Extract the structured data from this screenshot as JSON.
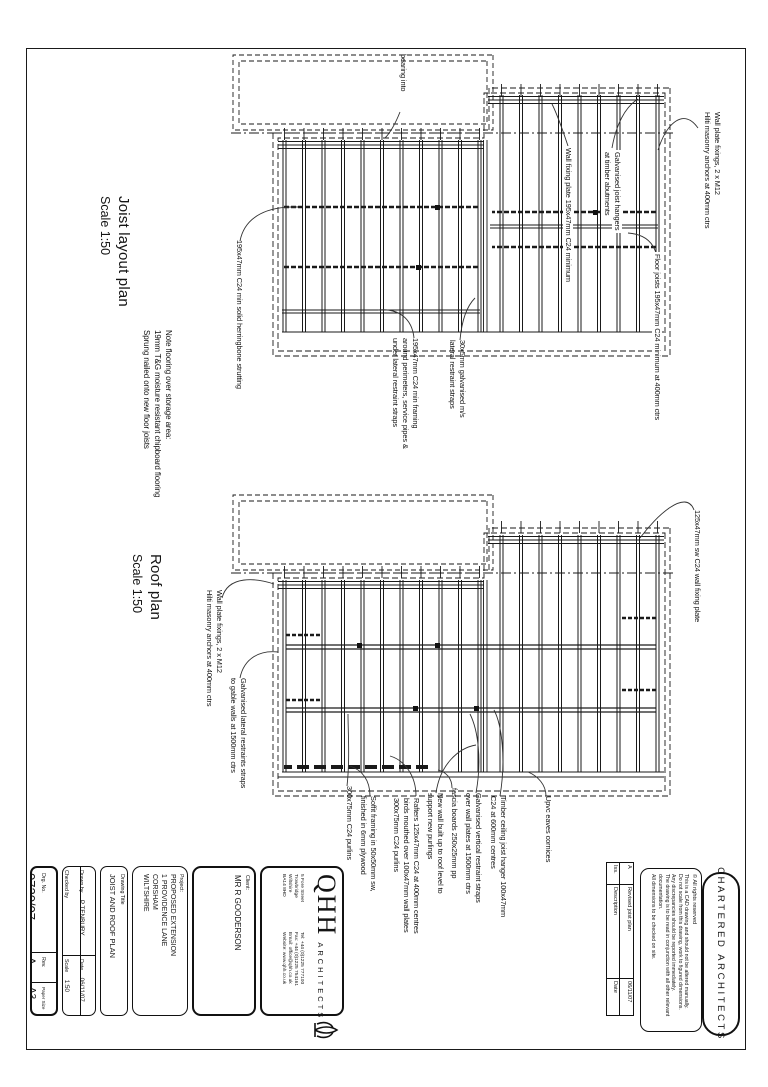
{
  "joist_plan": {
    "title": "Joist layout plan",
    "scale": "Scale 1:50",
    "note": [
      "Note flooring over storage area:",
      "19mm T&G moisture resistant chipboard flooring",
      "Sprung nailed onto new floor joists"
    ],
    "ann_bearing": "bearing into",
    "ann_wall_plate": [
      "Wall plate fixings, 2 x M12",
      "Hilti masonry anchors at 400mm ctrs"
    ],
    "ann_wall_fixing_plate": "Wall fixing plate 195x47mm C24 minimum",
    "ann_hangers": [
      "Galvanised joist hangers",
      "at timber abutments"
    ],
    "ann_floor_joists": "Floor joists 195x47mm C24 minimum at 400mm ctrs",
    "ann_strutting": "195x47mm C24 min solid herringbone strutting",
    "ann_framing": [
      "195x47mm C24 min framing",
      "around perimeters, service pipes &",
      "under lateral restraint straps"
    ],
    "ann_straps": [
      "30x5mm galvanised m/s",
      "lateral restraint straps"
    ]
  },
  "roof_plan": {
    "title": "Roof plan",
    "scale": "Scale 1:50",
    "ann_wall_plate": [
      "Wall plate fixings, 2 x M12",
      "Hilti masonry anchors at 400mm ctrs"
    ],
    "ann_gable_straps": [
      "Galvanised lateral restraints straps",
      "to gable walls at 1500mm ctrs"
    ],
    "ann_purlins": "300x75mm C24 purlins",
    "ann_soffit": [
      "Soffit framing in 50x50mm sw,",
      "finished in 6mm plywood"
    ],
    "ann_rafters": [
      "Rafters 125x47mm C24 at 400mm centres",
      "birds mouthed over 100x47mm wall plates",
      "300x75mm C24 purlins"
    ],
    "ann_new_wall": [
      "New wall built up to roof level to",
      "support new purlings"
    ],
    "ann_fascia": "fascia boards 250x25mm pp",
    "ann_vert_straps": [
      "Galvanised vertical restraint straps",
      "over wall plates at 1500mm ctrs"
    ],
    "ann_ceiling_hanger": [
      "Timber ceiling joist hanger 100x47mm",
      "C24 at 600mm centres"
    ],
    "ann_eaves": "Upvc eaves cornices",
    "ann_wall_fixing_plate": "125x47mm sw C24 wall fixing plate"
  },
  "title_block": {
    "drg_no_label": "Drg. No.",
    "drg_no": "0720/07",
    "rev_label": "Rev.",
    "rev": "A",
    "paper_label": "Paper Size",
    "paper": "A3",
    "drawn_label": "Drawn by",
    "drawn": "P TENBURY",
    "checked_label": "Checked by",
    "checked": "",
    "date_label": "Date",
    "date": "06/11/07",
    "scale_label": "Scale",
    "scale": "1:50",
    "title_label": "Drawing Title",
    "title": "JOIST AND ROOF PLAN",
    "project_label": "Project:",
    "project": [
      "PROPOSED EXTENSION",
      "1 PROVIDENCE LANE",
      "CORSHAM",
      "WILTSHIRE"
    ],
    "client_label": "Client:",
    "client": "MR R GOODERSON"
  },
  "firm": {
    "name": "QHH",
    "type": "ARCHITECTS",
    "address": [
      "5 Fore Street",
      "Trowbridge",
      "Wiltshire",
      "BA14 8HD"
    ],
    "contact": [
      "Tel: +44 (0)1225 777100",
      "Fax: +44 (0)1225 754161",
      "Email: office@qhh.co.uk",
      "Website: www.qhh.co.uk"
    ],
    "chartered": "CHARTERED ARCHITECTS"
  },
  "revisions": {
    "headers": [
      "Iss.",
      "Description",
      "Date"
    ],
    "rows": [
      [
        "A",
        "Revised joist plan",
        "06/11/07"
      ]
    ]
  },
  "notes": {
    "copyright": "© All rights reserved",
    "lines": [
      "This is a CAD drawing and should not be altered manually.",
      "Do not scale from this drawing, work to figured dimensions.",
      "Any discrepancies should be reported immediately.",
      "The drawing is to be read in conjunction with all other relevant documentation.",
      "All dimensions to be checked on site."
    ]
  }
}
